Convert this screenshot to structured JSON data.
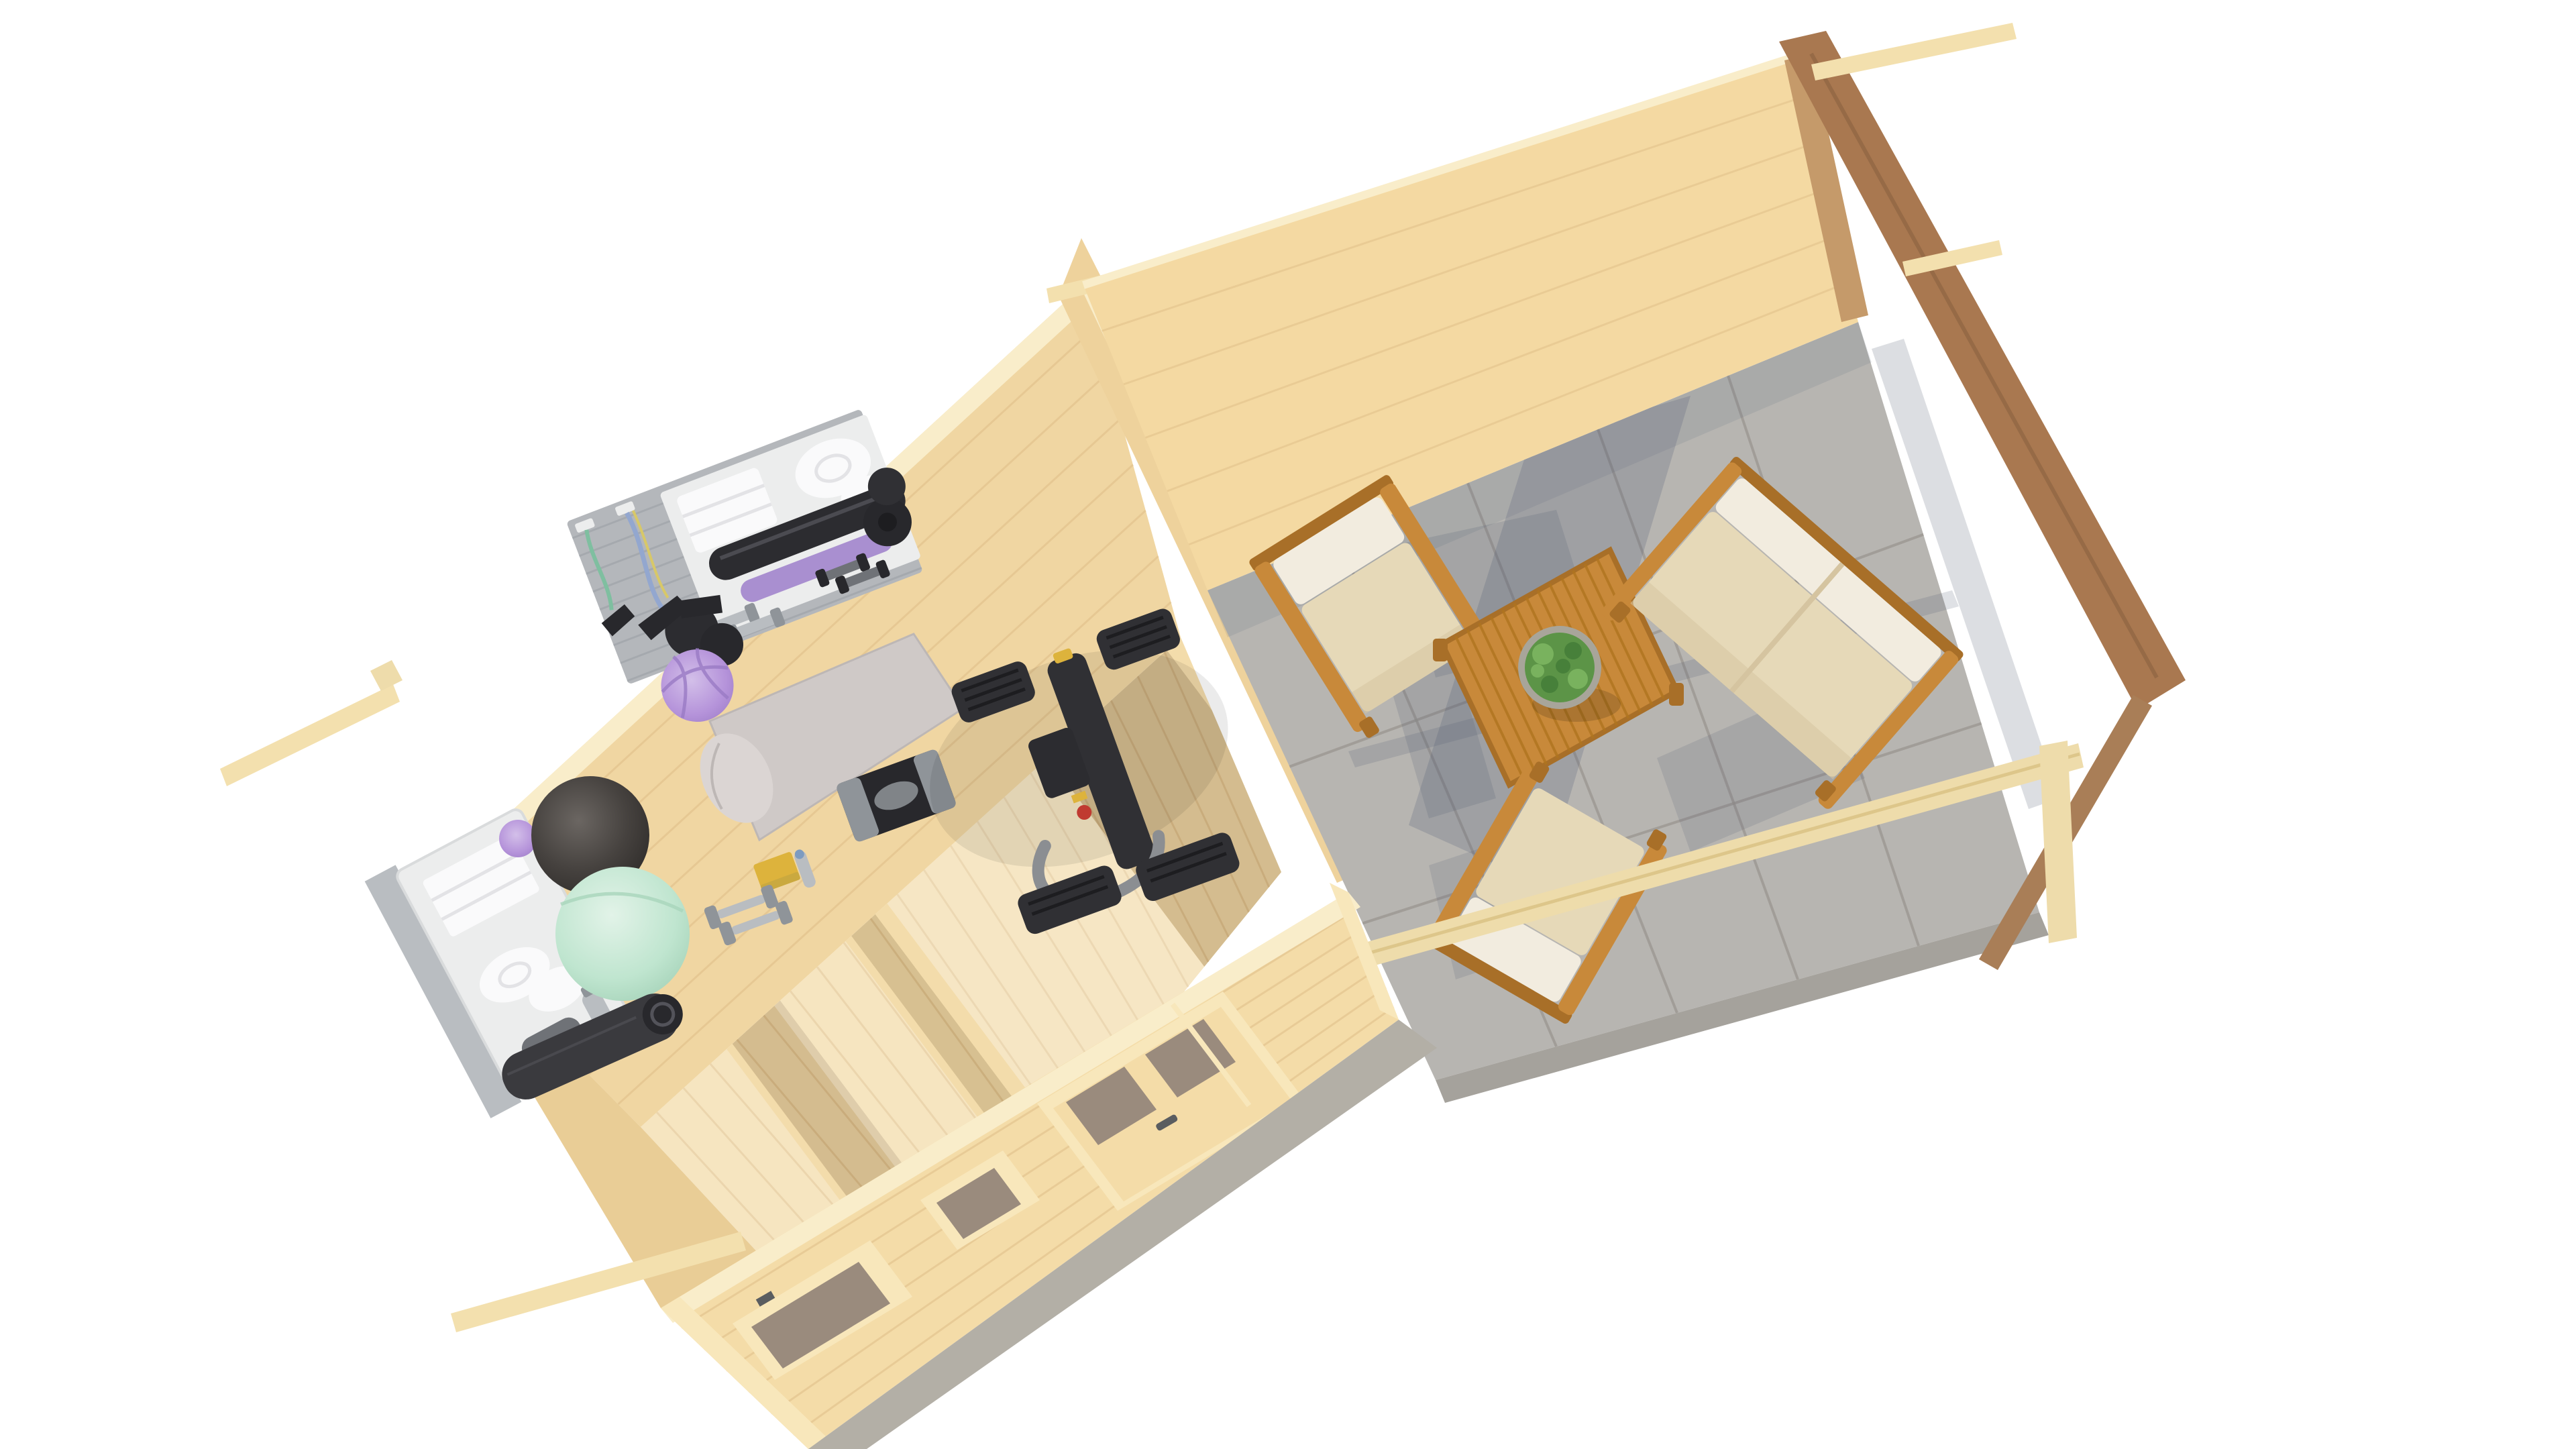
{
  "scene": {
    "type": "3d-architectural-render",
    "view": "aerial dollhouse / isometric top view on white background",
    "subject": "log cabin garden building with home gym room and covered terrace lounge",
    "background": "#ffffff"
  },
  "building": {
    "construction": "interlocking pine log walls, cutaway roof, gable frame over terrace",
    "rooms": [
      {
        "name": "gym-room",
        "floor": "light pine plank floor",
        "walls": "light pine logs"
      },
      {
        "name": "terrace",
        "floor": "gray concrete slabs",
        "edge": "wood railing and gable end frame"
      }
    ],
    "front_wall_openings": {
      "windows": 2,
      "door": "double door with glass panes and metal handle"
    }
  },
  "gym_equipment": [
    "wall rack with gray slat panel",
    "folded white towels",
    "rolled white towels",
    "black foam roller",
    "purple foam roller",
    "light dumbbell pair",
    "dark dumbbell pair",
    "black kettlebell weights",
    "green resistance band",
    "blue-yellow resistance band",
    "small purple pilates ball",
    "white storage shelf with towels and bottle",
    "dark gray exercise ball",
    "mint green exercise ball",
    "rolled black yoga mat",
    "light gray yoga mat",
    "black aerobic stepper",
    "yellow yoga block",
    "water bottle",
    "gray dumbbell pair on floor",
    "black exercise machine with gray handlebar"
  ],
  "terrace_furniture": [
    "wooden armchair with cream cushions (back-left)",
    "wooden two-seat sofa with cream cushions (right)",
    "wooden armchair with cream cushions (front, under railing beam)",
    "slatted wooden coffee table",
    "round potted green plant"
  ],
  "lighting": {
    "sun_shadows": "long blue-gray shadows across concrete, bright door/window light patches on gym floor"
  },
  "colors": {
    "bg": "#ffffff",
    "pineFloor": "#f3dcab",
    "woodSeam": "#d9b67e",
    "pineWallBack": "#f0d6a2",
    "logLine": "#ddbb85",
    "pineWallWest": "#e9cd96",
    "frontWall": "#f4dca8",
    "cutFace": "#f9edca",
    "trim": "#f8e7bb",
    "glass": "#9a8b7d",
    "doorHandle": "#5a5d60",
    "foundation": "#b3afa6",
    "concrete": "#b7b5b1",
    "tileJoint": "#98948e",
    "concreteSide": "#a5a29c",
    "shadow": "#4e5870",
    "gymShadow": "#6b4e2e",
    "sunlight": "#ffffff",
    "divWall": "#eed29c",
    "terraceWall": "#f4d9a2",
    "wallEndBrown": "#c59a6a",
    "gableBrown": "#a97850",
    "beamLight": "#f3e0ae",
    "railWood": "#eedcab",
    "braceBrown": "#a97e57",
    "furnWood": "#c8893a",
    "furnWoodDark": "#a86f28",
    "cushion": "#e6d9b8",
    "cushionBack": "#f2ecdf",
    "cushionShade": "#d5c4a0",
    "tableSlat": "#b0751f",
    "plantGreen": "#5c9447",
    "plantDark": "#47803a",
    "plantLight": "#79b25e",
    "pot": "#a8a59a",
    "rackPanel": "#b4b7bb",
    "rackSlat": "#a2a6ab",
    "whiteUnit": "#eceded",
    "towel": "#fafafb",
    "towelShade": "#e3e3e6",
    "rollerBlack": "#2c2c30",
    "rollerSheen": "#53535a",
    "purple": "#a98fd0",
    "purpleBall": "#b593da",
    "purpleSeam": "#9a7bc5",
    "grayLight": "#b9bdc1",
    "grayMid": "#8f9499",
    "grayDark": "#6f7277",
    "black": "#28282c",
    "machineBody": "#303034",
    "machineRib": "#1d1d20",
    "handleGray": "#8b8e92",
    "yellow": "#ddb33c",
    "red": "#c03a31",
    "mint": "#bfe5cf",
    "mintHi": "#e2f3e8",
    "darkBall": "#3c3937",
    "darkBallHi": "#6b6662",
    "matGray": "#cfc9c7",
    "matRoll": "#dbd5d3",
    "matDark": "#3a3a3e",
    "bandGreen": "#7fbfa0",
    "bandBlue": "#93a7cf",
    "bandYellow": "#d8c868"
  }
}
